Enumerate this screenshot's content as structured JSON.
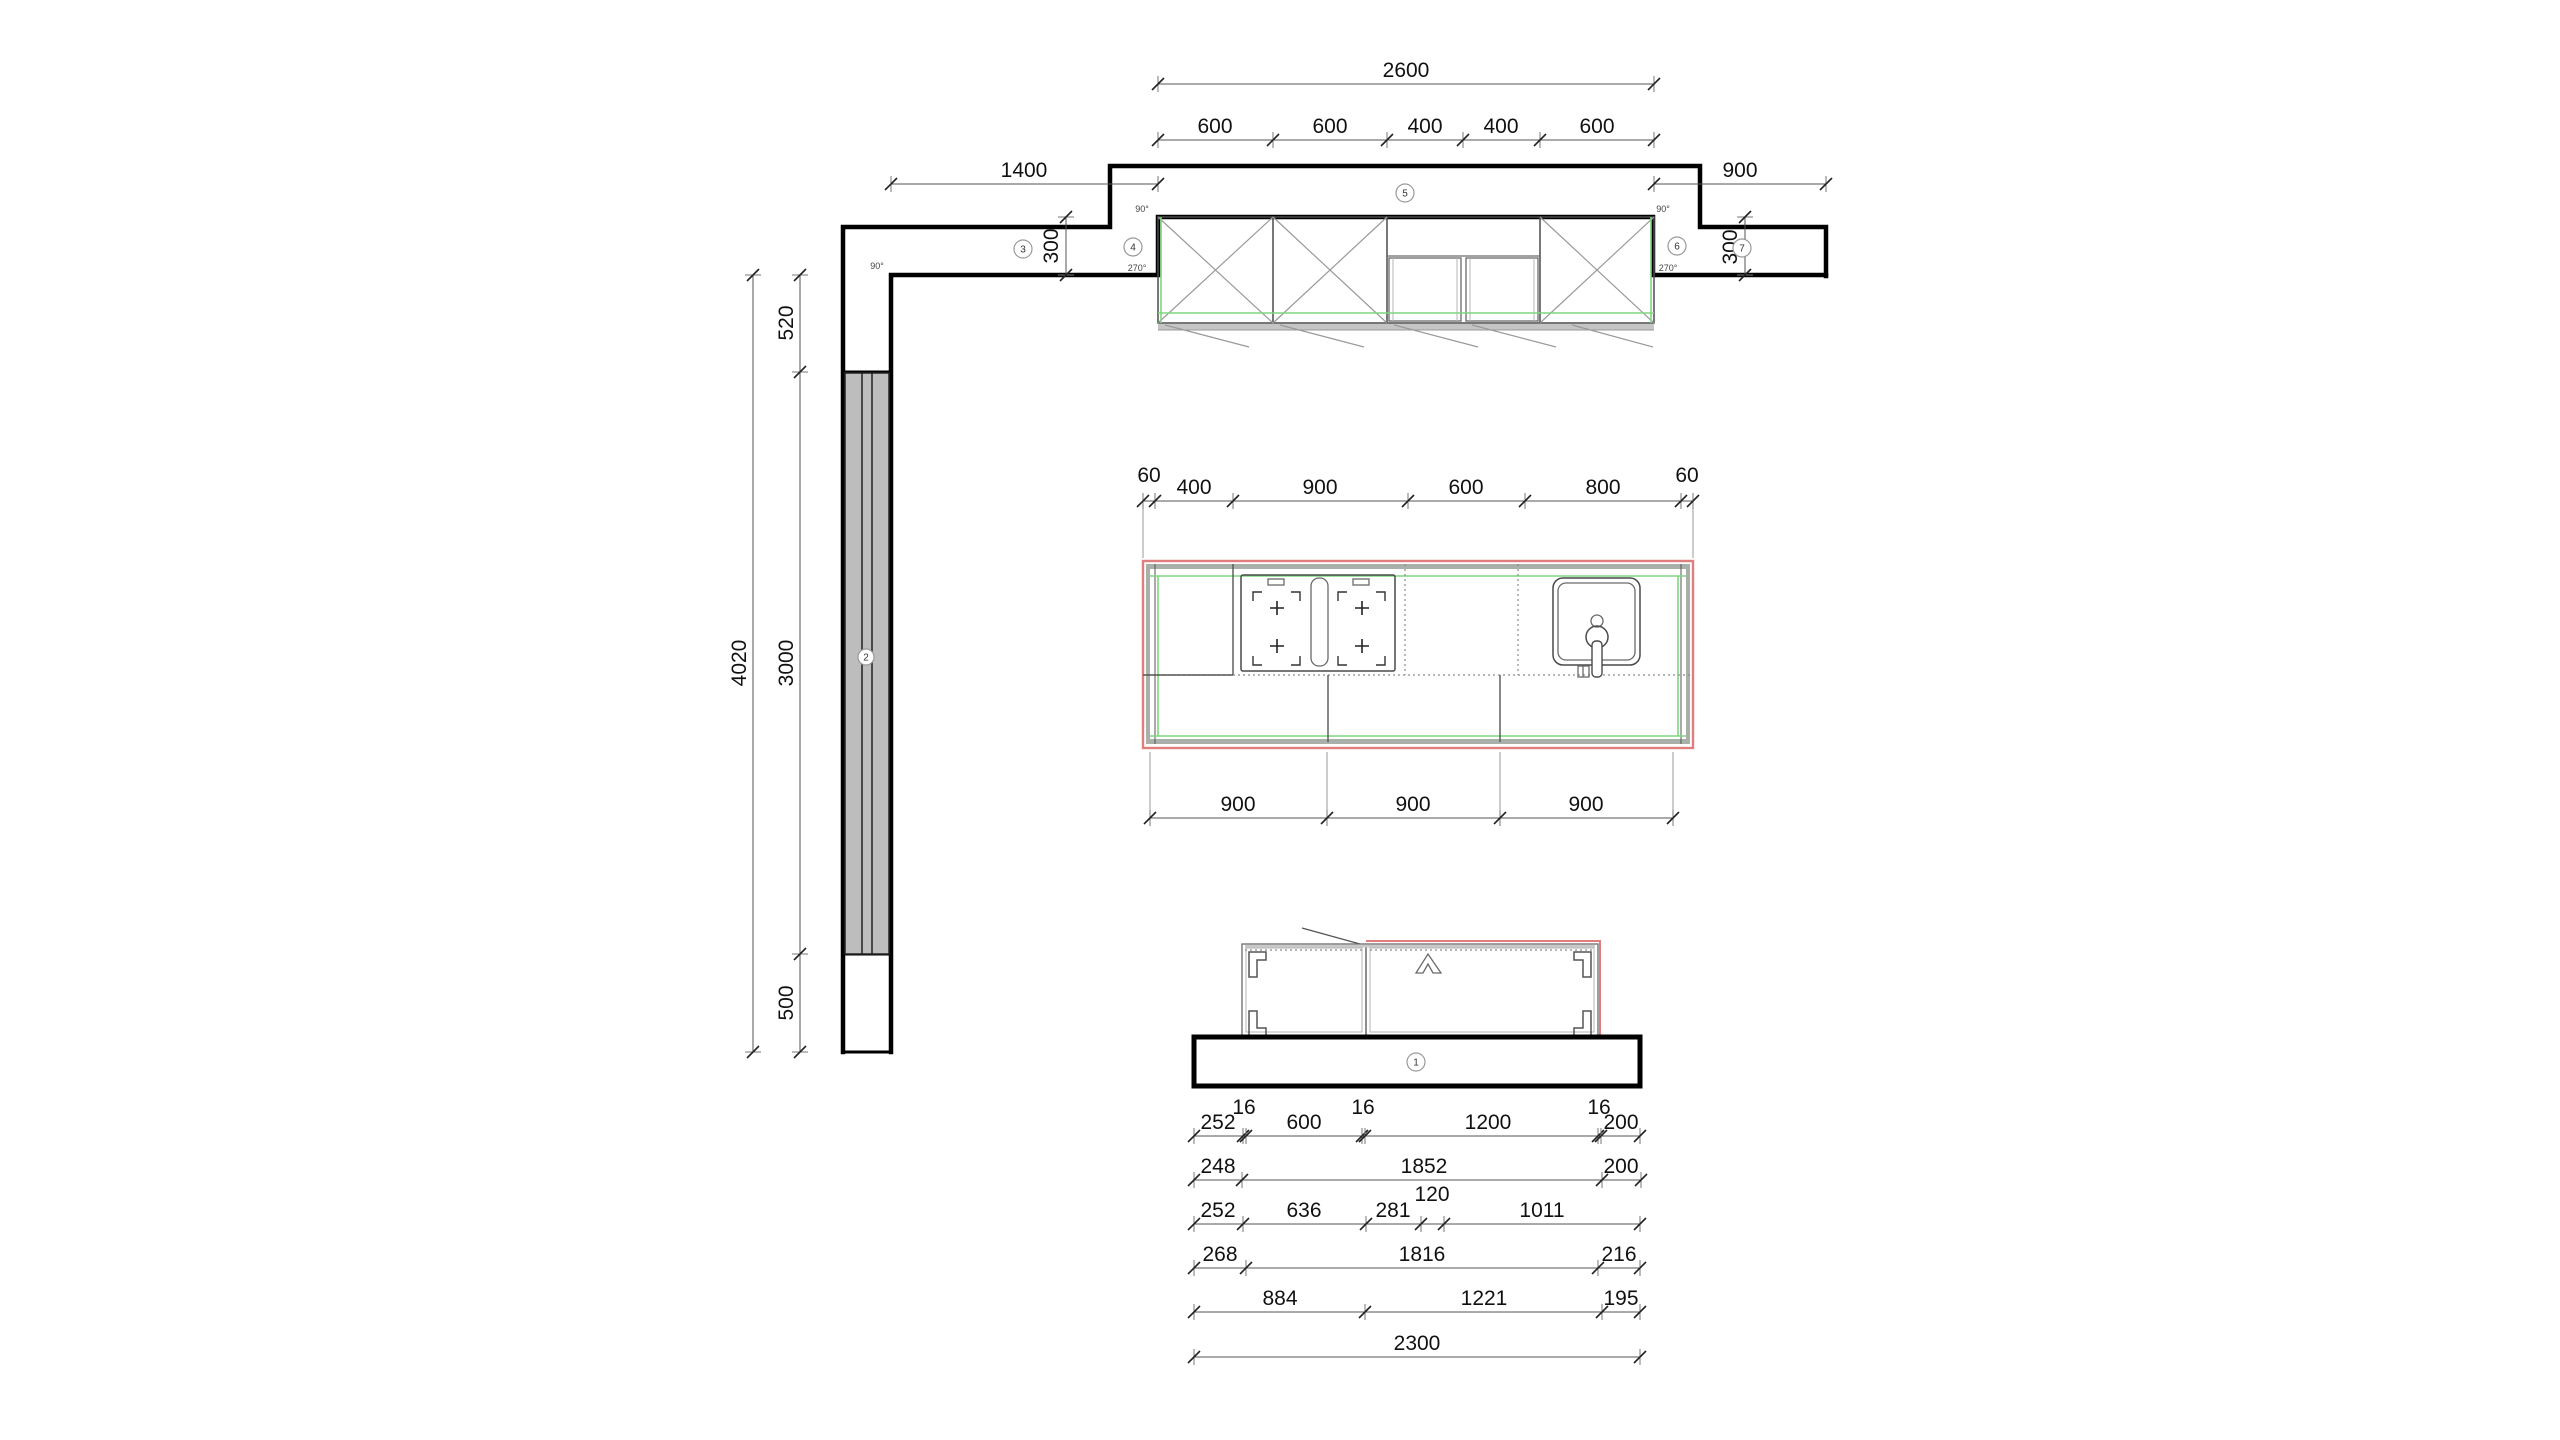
{
  "colors": {
    "background": "#ffffff",
    "wall_line": "#000000",
    "counter_outline_red": "#e07d7d",
    "reference_green": "#7fd67f",
    "door_gray_fill": "#bdbdbd",
    "cabinet_gray_band": "#c5c5c5",
    "dim_line": "#555555"
  },
  "top_plan": {
    "dim_total": "2600",
    "dim_segments": [
      "600",
      "600",
      "400",
      "400",
      "600"
    ],
    "dim_left_wall": "1400",
    "dim_right_wall": "900",
    "dim_offset_left": "300",
    "dim_offset_right": "300",
    "angle_90": "90°",
    "angle_270": "270°"
  },
  "left_wall_section": {
    "dim_total": "4020",
    "dim_segments": [
      "520",
      "3000",
      "500"
    ]
  },
  "counter_plan": {
    "dim_segments_top": [
      "60",
      "400",
      "900",
      "600",
      "800",
      "60"
    ],
    "dim_segments_bottom": [
      "900",
      "900",
      "900"
    ]
  },
  "bottom_section": {
    "dim_row_1": [
      "252",
      "16",
      "600",
      "16",
      "1200",
      "16",
      "200"
    ],
    "dim_row_2": [
      "248",
      "1852",
      "200"
    ],
    "dim_row_3": [
      "252",
      "636",
      "281",
      "120",
      "1011"
    ],
    "dim_row_4": [
      "268",
      "1816",
      "216"
    ],
    "dim_row_5": [
      "884",
      "1221",
      "195"
    ],
    "dim_row_6": [
      "2300"
    ]
  },
  "markers": {
    "m1": "1",
    "m2": "2",
    "m3": "3",
    "m4": "4",
    "m5": "5",
    "m6": "6",
    "m7": "7"
  }
}
